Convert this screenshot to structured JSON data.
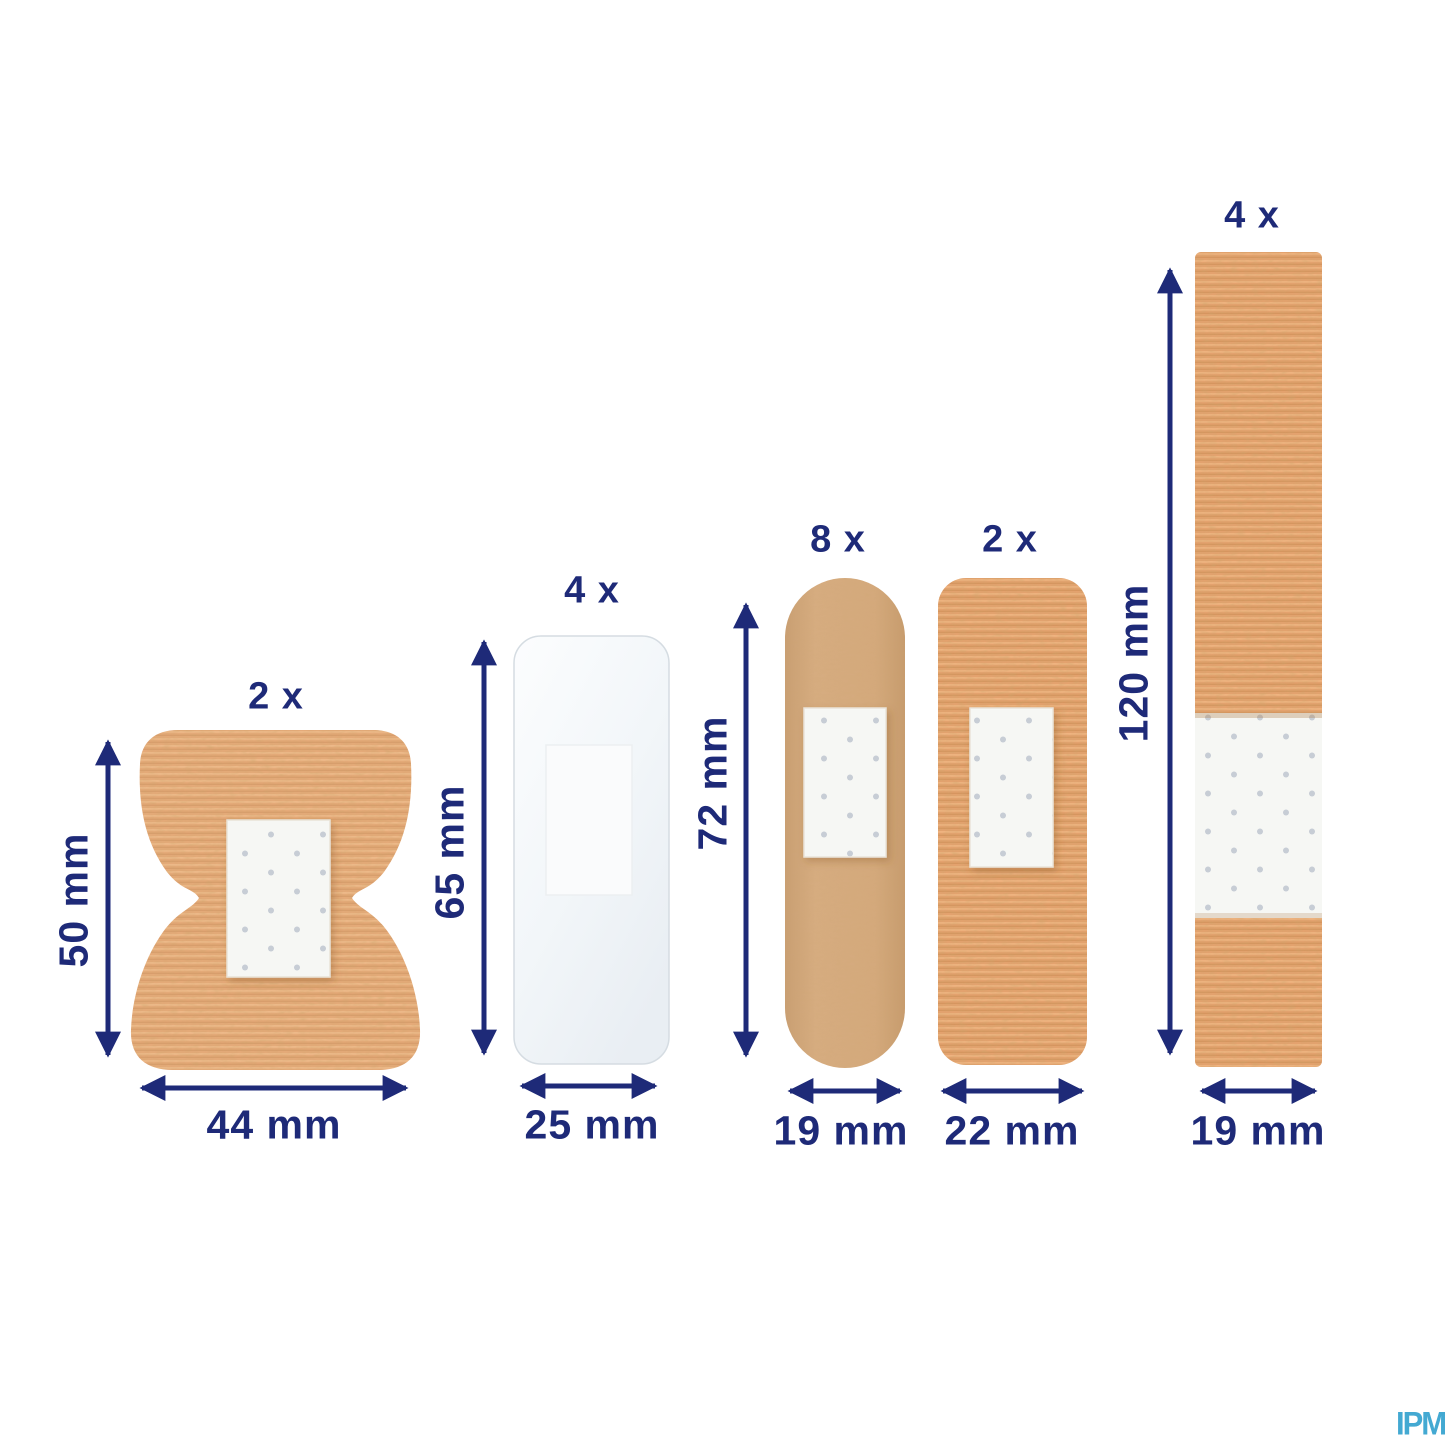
{
  "bandages": [
    {
      "type": "fingertip-plaster",
      "count": "2 x",
      "length": "50 mm",
      "width": "44 mm"
    },
    {
      "type": "transparent-plaster",
      "count": "4 x",
      "length": "65 mm",
      "width": "25 mm"
    },
    {
      "type": "classic-strip",
      "count": "8 x",
      "length": "72 mm",
      "width": "19 mm"
    },
    {
      "type": "wide-strip",
      "count": "2 x",
      "width": "22 mm"
    },
    {
      "type": "long-strip",
      "count": "4 x",
      "length": "120 mm",
      "width": "19 mm"
    }
  ],
  "watermark": "IPM",
  "colors": {
    "annotation_navy": "#1e2a78",
    "watermark_blue": "#43a9d2",
    "fabric_tan": "#e5aa79",
    "fabric_orange": "#e4a26e",
    "smooth_tan": "#d3a87a",
    "pad_white": "#f6f7f4",
    "background": "#ffffff"
  }
}
